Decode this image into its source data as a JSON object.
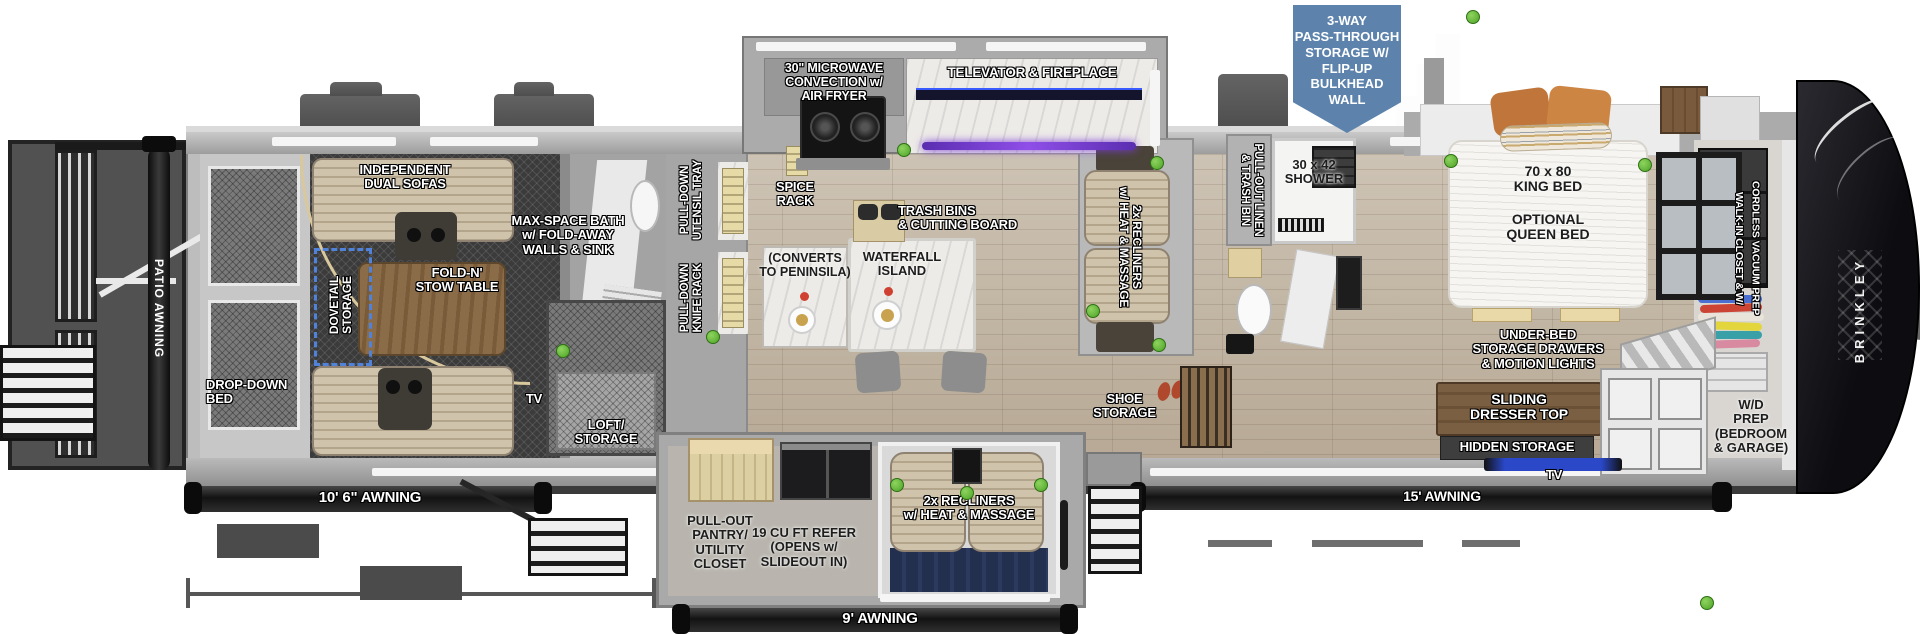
{
  "brand": "BRINKLEY",
  "callout": {
    "text": "3-WAY\nPASS-THROUGH\nSTORAGE W/\nFLIP-UP\nBULKHEAD\nWALL"
  },
  "colors": {
    "callout_blue": "#5d83ad",
    "green_dot": "#5fbe3a",
    "led_purple": "#7a3bd8",
    "awning_bar": "#1c1c1c"
  },
  "garage": {
    "patio_awning": "PATIO AWNING",
    "awning": "10' 6\" AWNING",
    "sofas": "INDEPENDENT\nDUAL SOFAS",
    "table": "FOLD-N'\nSTOW TABLE",
    "dovetail": "DOVETAIL\nSTORAGE",
    "bed": "DROP-DOWN\nBED",
    "tv": "TV",
    "bath": "MAX-SPACE BATH\nw/ FOLD-AWAY\nWALLS & SINK",
    "loft": "LOFT/\nSTORAGE"
  },
  "kitchen": {
    "microwave": "30\" MICROWAVE\nCONVECTION w/\nAIR FRYER",
    "televator": "TELEVATOR & FIREPLACE",
    "utensil_tray": "PULL-DOWN\nUTENSIL TRAY",
    "knife_rack": "PULL-DOWN\nKNIFE RACK",
    "spice_rack": "SPICE\nRACK",
    "converts": "(CONVERTS\nTO PENINSILA)",
    "island": "WATERFALL\nISLAND",
    "trash": "TRASH BINS\n& CUTTING BOARD"
  },
  "living": {
    "recliners": "2x RECLINERS\nw/ HEAT & MASSAGE",
    "shoe_storage": "SHOE\nSTORAGE"
  },
  "bath": {
    "linen": "PULL-OUT LINEN\n& TRASH BIN",
    "shower": "30 x 42\nSHOWER"
  },
  "bedroom": {
    "king": "70 x 80\nKING BED",
    "queen": "OPTIONAL\nQUEEN BED",
    "underbed": "UNDER-BED\nSTORAGE DRAWERS\n& MOTION LIGHTS",
    "dresser": "SLIDING\nDRESSER TOP",
    "hidden": "HIDDEN STORAGE",
    "tv": "TV",
    "wd": "W/D\nPREP\n(BEDROOM\n& GARAGE)",
    "closet": "WALK-IN CLOSET & W/\nCORDLESS VACUUM PREP",
    "awning": "15' AWNING"
  },
  "bottom_slide": {
    "pantry": "PULL-OUT\nPANTRY/\nUTILITY\nCLOSET",
    "refer": "19 CU FT REFER\n(OPENS w/\nSLIDEOUT IN)",
    "recliners": "2x RECLINERS\nw/ HEAT & MASSAGE",
    "awning": "9' AWNING"
  }
}
